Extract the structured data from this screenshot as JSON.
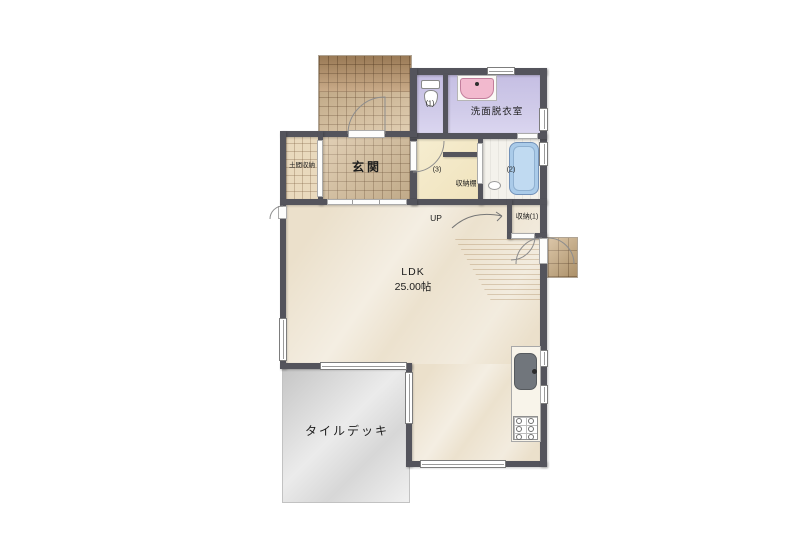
{
  "rooms": {
    "doma_storage": "土間収納",
    "genkan": "玄関",
    "toilet_num": "(1)",
    "washroom": "洗面脱衣室",
    "hall_num": "(3)",
    "shelf": "収納棚",
    "bath_num": "(2)",
    "stairs_up": "UP",
    "closet1": "収納(1)",
    "ldk_name": "LDK",
    "ldk_area": "25.00帖",
    "deck": "タイルデッキ"
  },
  "colors": {
    "wall": "#54545c",
    "porch_tile": "#c9a87c",
    "genkan_tile": "#d6bd98",
    "sanitary_lavender": "#ccc6e8",
    "hall_cream": "#f3e9c9",
    "ldk_floor": "#ebe0cb",
    "deck_gray": "#d6d6d6",
    "tub_blue": "#aacbe9",
    "basin_pink": "#f2b9ce",
    "kitchen_sink_gray": "#71767c"
  }
}
